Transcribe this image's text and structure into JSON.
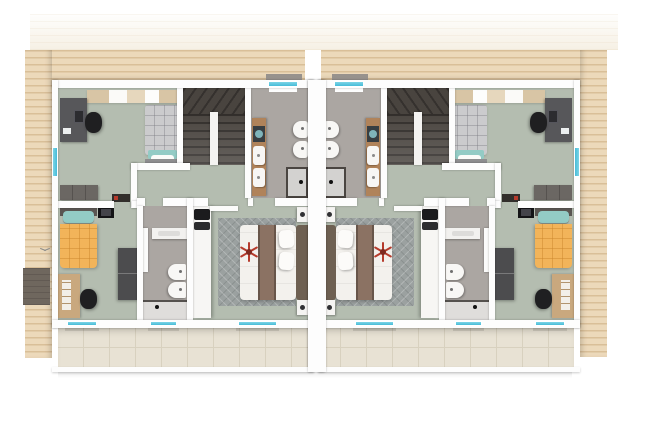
{
  "meta": {
    "content_type": "architectural-floorplan-3d-render",
    "view": "top-down",
    "description": "Mirrored duplex upper-floor plan render on white background, wood-plank roof surround, front terraces at bottom"
  },
  "palette": {
    "background": "#ffffff",
    "roof": "#ecd9ba",
    "skylight": "#6f675e",
    "wall": "#fdfdfd",
    "floor": "#b4bdb0",
    "bathFloor": "#aba6a2",
    "stairDark": "#474340",
    "window": "#46bcd8",
    "terrace": "#e8e2d4",
    "terraceLine": "#d8d1bf",
    "woodVanity": "#b0835a",
    "woodDesk": "#c9a87e",
    "orangeBed": "#f2b45a",
    "tealPillow": "#93cbc5",
    "masterRunner": "#8b7263",
    "headboard": "#6e6052",
    "rug": "#9ba1a0",
    "desk": "#57575a",
    "dresserGray": "#6b6763",
    "wardrobe": "#4c4c4e",
    "chair": "#1f1f21",
    "closet": "#f7f6f4",
    "fan": "#b63b2c",
    "washerGlass": "#7fb4ba",
    "lintel": "#97928d"
  },
  "floorplan": {
    "units": [
      {
        "side": "left",
        "mirrored": false
      },
      {
        "side": "right",
        "mirrored": true
      }
    ],
    "rooms_per_unit": [
      {
        "name": "office-bedroom",
        "floor": "sage",
        "furniture": [
          "desk",
          "office-chair",
          "laptop",
          "wall-shelf",
          "single-bed",
          "dresser",
          "media-console"
        ]
      },
      {
        "name": "stairwell",
        "floor": "dark-stairs",
        "furniture": [
          "u-shaped-winder-stair",
          "spine-wall"
        ]
      },
      {
        "name": "main-bathroom",
        "floor": "gray-tile",
        "furniture": [
          "wood-vanity",
          "washing-machine",
          "basin",
          "basin",
          "toilet",
          "bidet",
          "shower"
        ]
      },
      {
        "name": "kid-bedroom",
        "floor": "sage",
        "furniture": [
          "orange-single-bed",
          "teal-pillow",
          "wall-tv",
          "wood-desk",
          "chair",
          "wardrobe"
        ]
      },
      {
        "name": "small-bathroom",
        "floor": "gray-tile",
        "furniture": [
          "sink-counter",
          "toilet",
          "bidet",
          "shower",
          "door"
        ]
      },
      {
        "name": "master-bedroom",
        "floor": "sage",
        "furniture": [
          "white-closet",
          "tv-unit",
          "herringbone-rug",
          "double-bed",
          "runner-blanket",
          "pillow",
          "pillow",
          "headboard",
          "nightstand",
          "nightstand",
          "ceiling-fan",
          "door"
        ]
      },
      {
        "name": "hallway",
        "floor": "sage",
        "furniture": []
      },
      {
        "name": "terrace",
        "floor": "beige-tile",
        "furniture": []
      }
    ],
    "windows_per_unit": {
      "top_wall": 1,
      "side_wall": 1,
      "bottom_wall": 3
    },
    "exterior_features": [
      "wood-plank-roof-surround",
      "rear-roof-slope-band",
      "skylight-patch-left-roof",
      "center-party-wall",
      "terrace-divider",
      "window-lintels",
      "building-shadow"
    ]
  }
}
